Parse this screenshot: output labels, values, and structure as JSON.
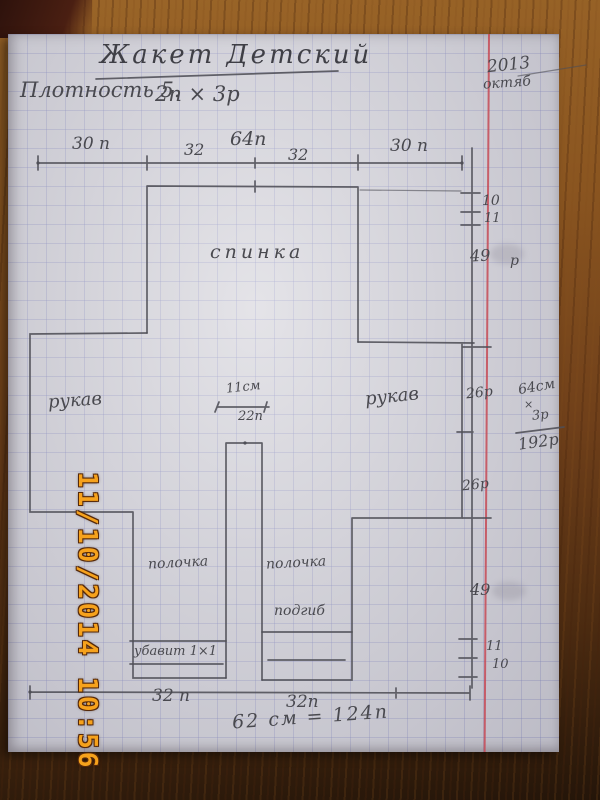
{
  "photo": {
    "timestamp": "11/10/2014 10:56",
    "colors": {
      "stamp_orange": "#f6a21c",
      "margin_red": "#c64a56",
      "pencil_gray": "#4f4f57",
      "paper": "#d4d3da",
      "wood_brown": "#8a5520"
    }
  },
  "page": {
    "title": "Жакет Детский",
    "gauge_label": "Плотность 5.",
    "gauge_value": "2п × 3р",
    "corner_year": "2013",
    "corner_month": "октяб",
    "top_dims": [
      "30 п",
      "32",
      "64п",
      "32",
      "30 п"
    ],
    "labels": {
      "back": "спинка",
      "sleeve_left": "рукав",
      "sleeve_right": "рукав",
      "front_left": "полочка",
      "front_right": "полочка",
      "hem": "подгиб",
      "decrease": "убавит 1×1",
      "neck_cm": "11см",
      "neck_st": "22п"
    },
    "right_dims": {
      "d10_top": "10",
      "d11_top": "11",
      "d49_top": "49",
      "d49_top_suffix": "р",
      "d26_upper": "26р",
      "d26_lower": "26р",
      "d49_bottom": "49",
      "d11_bottom": "11",
      "d10_bottom": "10"
    },
    "calc": {
      "line1": "64см",
      "op": "×",
      "line2": "3р",
      "result": "192р"
    },
    "bottom_dims": {
      "left": "32 п",
      "right": "32п",
      "total": "62 см = 124п"
    }
  }
}
